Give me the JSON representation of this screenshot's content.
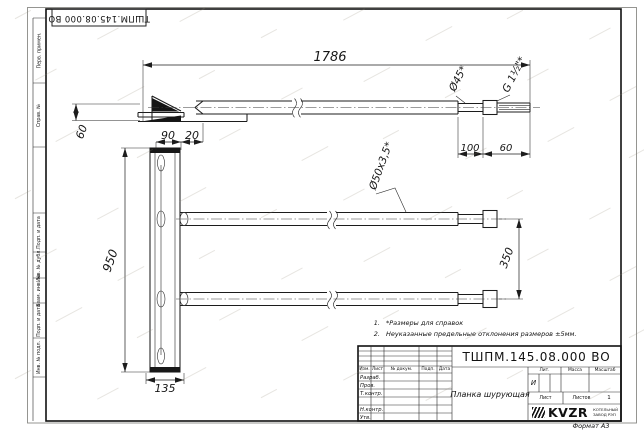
{
  "doc_number": "ТШПМ.145.08.000 ВО",
  "frame": {
    "side_labels": [
      "Перв. примен.",
      "Справ. №",
      "Подп. и дата",
      "Инв. № дубл.",
      "Взам. инв. №",
      "Подп. и дата",
      "Инв. № подл."
    ],
    "format_label": "Формат А3"
  },
  "drawing": {
    "dims": {
      "length_total": "1786",
      "blade_height": "60",
      "plate_width": "90",
      "plate_offset": "20",
      "plate_height": "950",
      "plate_bottom_width": "135",
      "tube_spacing": "350",
      "end_step_length": "100",
      "end_thread_length": "60",
      "tube_section": "Ø50х3,5*",
      "end_diameter": "Ø45*",
      "thread_size": "G 1½\"*"
    },
    "notes": [
      {
        "num": "1.",
        "text": "*Размеры для справок"
      },
      {
        "num": "2.",
        "text": "Неуказанные предельные отклонения размеров ±5мм."
      }
    ]
  },
  "title_block": {
    "name": "Планка шурующая",
    "header_cols": [
      "Изм.",
      "Лист",
      "№ докум.",
      "Подп.",
      "Дата"
    ],
    "rows": [
      "Разраб.",
      "Пров.",
      "Т.контр.",
      "",
      "Н.контр.",
      "Утв."
    ],
    "lit_label": "Лит.",
    "lit_value": "И",
    "mass_label": "Масса",
    "scale_label": "Масштаб",
    "sheet_label": "Лист",
    "sheets_label": "Листов",
    "sheets_value": "1",
    "logo_text": "KVZR",
    "org_line1": "КОТЕЛЬНЫЙ",
    "org_line2": "ЗАВОД РЭП"
  }
}
